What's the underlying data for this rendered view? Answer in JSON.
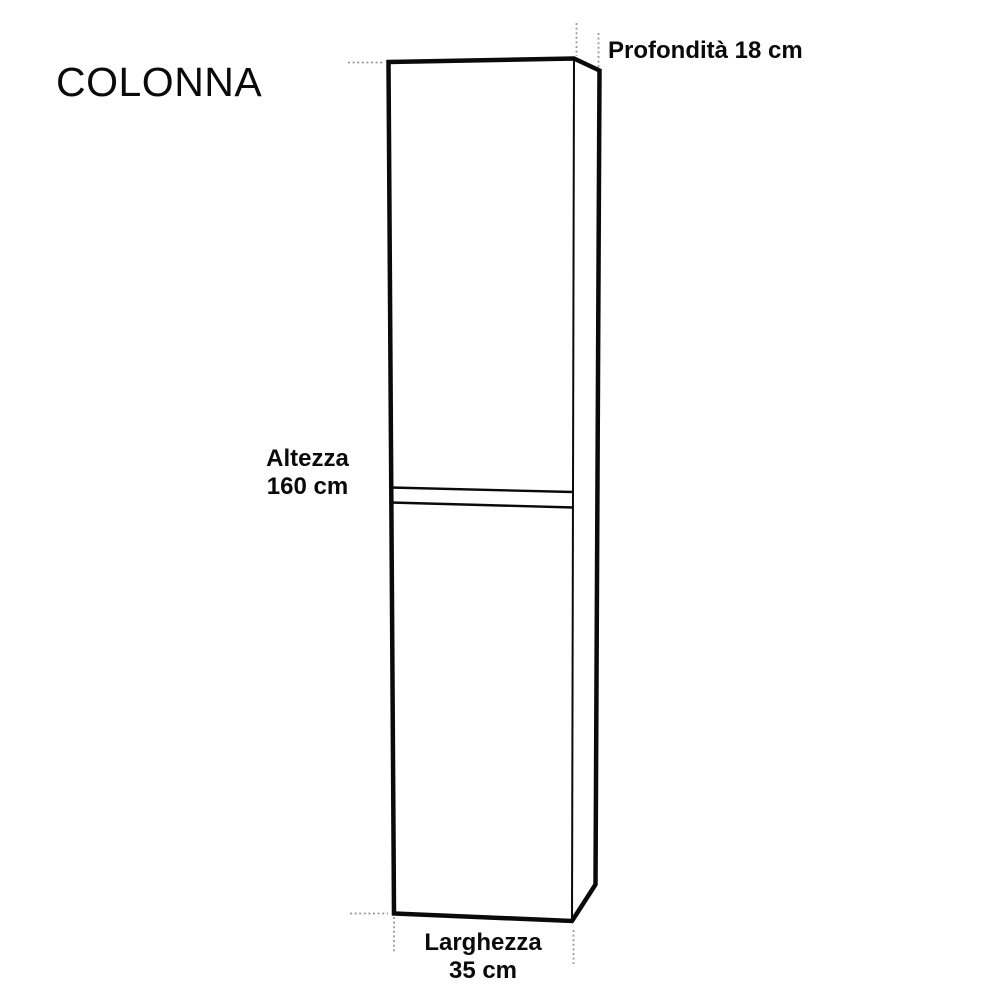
{
  "title": "COLONNA",
  "dimensions": {
    "depth": {
      "label": "Profondità",
      "value": 18,
      "unit": "cm",
      "value_text": "18 cm"
    },
    "height": {
      "label": "Altezza",
      "value": 160,
      "unit": "cm",
      "value_text": "160 cm"
    },
    "width": {
      "label": "Larghezza",
      "value": 35,
      "unit": "cm",
      "value_text": "35 cm"
    }
  },
  "colors": {
    "line": "#0a0a0a",
    "extension_line": "#9a9a9a",
    "background": "#ffffff",
    "text": "#0a0a0a"
  }
}
